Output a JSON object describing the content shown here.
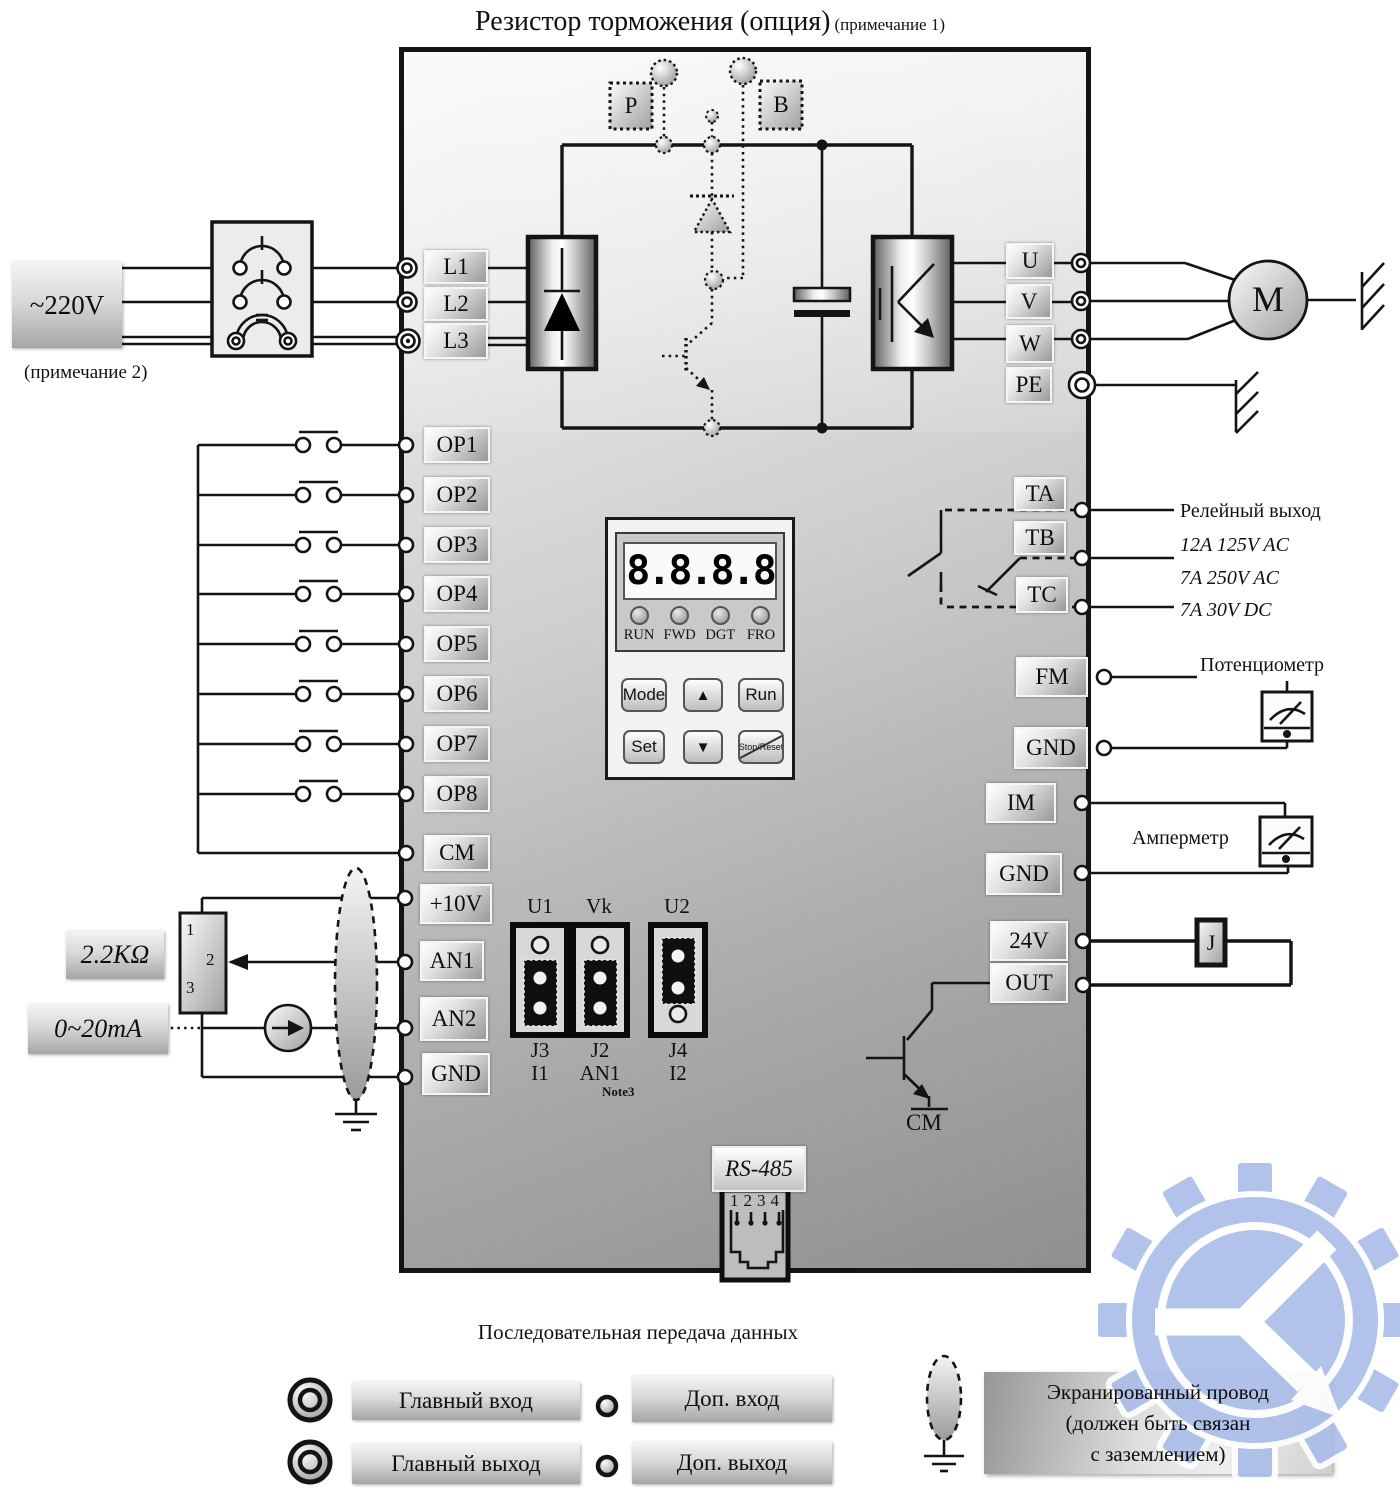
{
  "title": {
    "main": "Резистор торможения (опция)",
    "note": "(примечание 1)"
  },
  "note2": "(примечание 2)",
  "source": {
    "voltage": "~220V"
  },
  "input_terminals": [
    "L1",
    "L2",
    "L3"
  ],
  "brake": {
    "p": "P",
    "b": "B"
  },
  "output_terminals": [
    "U",
    "V",
    "W",
    "PE"
  ],
  "motor": "M",
  "digital_inputs": [
    "OP1",
    "OP2",
    "OP3",
    "OP4",
    "OP5",
    "OP6",
    "OP7",
    "OP8"
  ],
  "common": "CM",
  "keypad": {
    "display": "8.8.8.8",
    "leds": [
      "RUN",
      "FWD",
      "DGT",
      "FRO"
    ],
    "mode": "Mode",
    "up": "▲",
    "run": "Run",
    "set": "Set",
    "down": "▼",
    "stop": "Stop/Reset"
  },
  "relay": {
    "ta": "TA",
    "tb": "TB",
    "tc": "TC",
    "title": "Релейный выход",
    "r1": "12A 125V AC",
    "r2": "7A 250V AC",
    "r3": "7A 30V DC"
  },
  "analog_out": {
    "fm": "FM",
    "gnd1": "GND",
    "pot": "Потенциометр",
    "im": "IM",
    "gnd2": "GND",
    "ammeter": "Амперметр"
  },
  "digital_out": {
    "v24": "24V",
    "out": "OUT",
    "coil": "J",
    "cm": "CM"
  },
  "analog_in": {
    "p10": "+10V",
    "an1": "AN1",
    "an2": "AN2",
    "gnd": "GND",
    "resistor": "2.2KΩ",
    "current": "0~20mA",
    "pin1": "1",
    "pin2": "2",
    "pin3": "3"
  },
  "jumpers": {
    "u1": "U1",
    "vk": "Vk",
    "u2": "U2",
    "j3": "J3",
    "i1": "I1",
    "j2": "J2",
    "an1": "AN1",
    "j4": "J4",
    "i2": "I2",
    "note": "Note3"
  },
  "comm": {
    "rs485": "RS-485",
    "pins": "1234",
    "caption": "Последовательная передача данных"
  },
  "legend": {
    "main_in": "Главный вход",
    "aux_in": "Доп. вход",
    "main_out": "Главный выход",
    "aux_out": "Доп. выход",
    "shield1": "Экранированный провод",
    "shield2": "(должен быть связан",
    "shield3": "с заземлением)"
  }
}
